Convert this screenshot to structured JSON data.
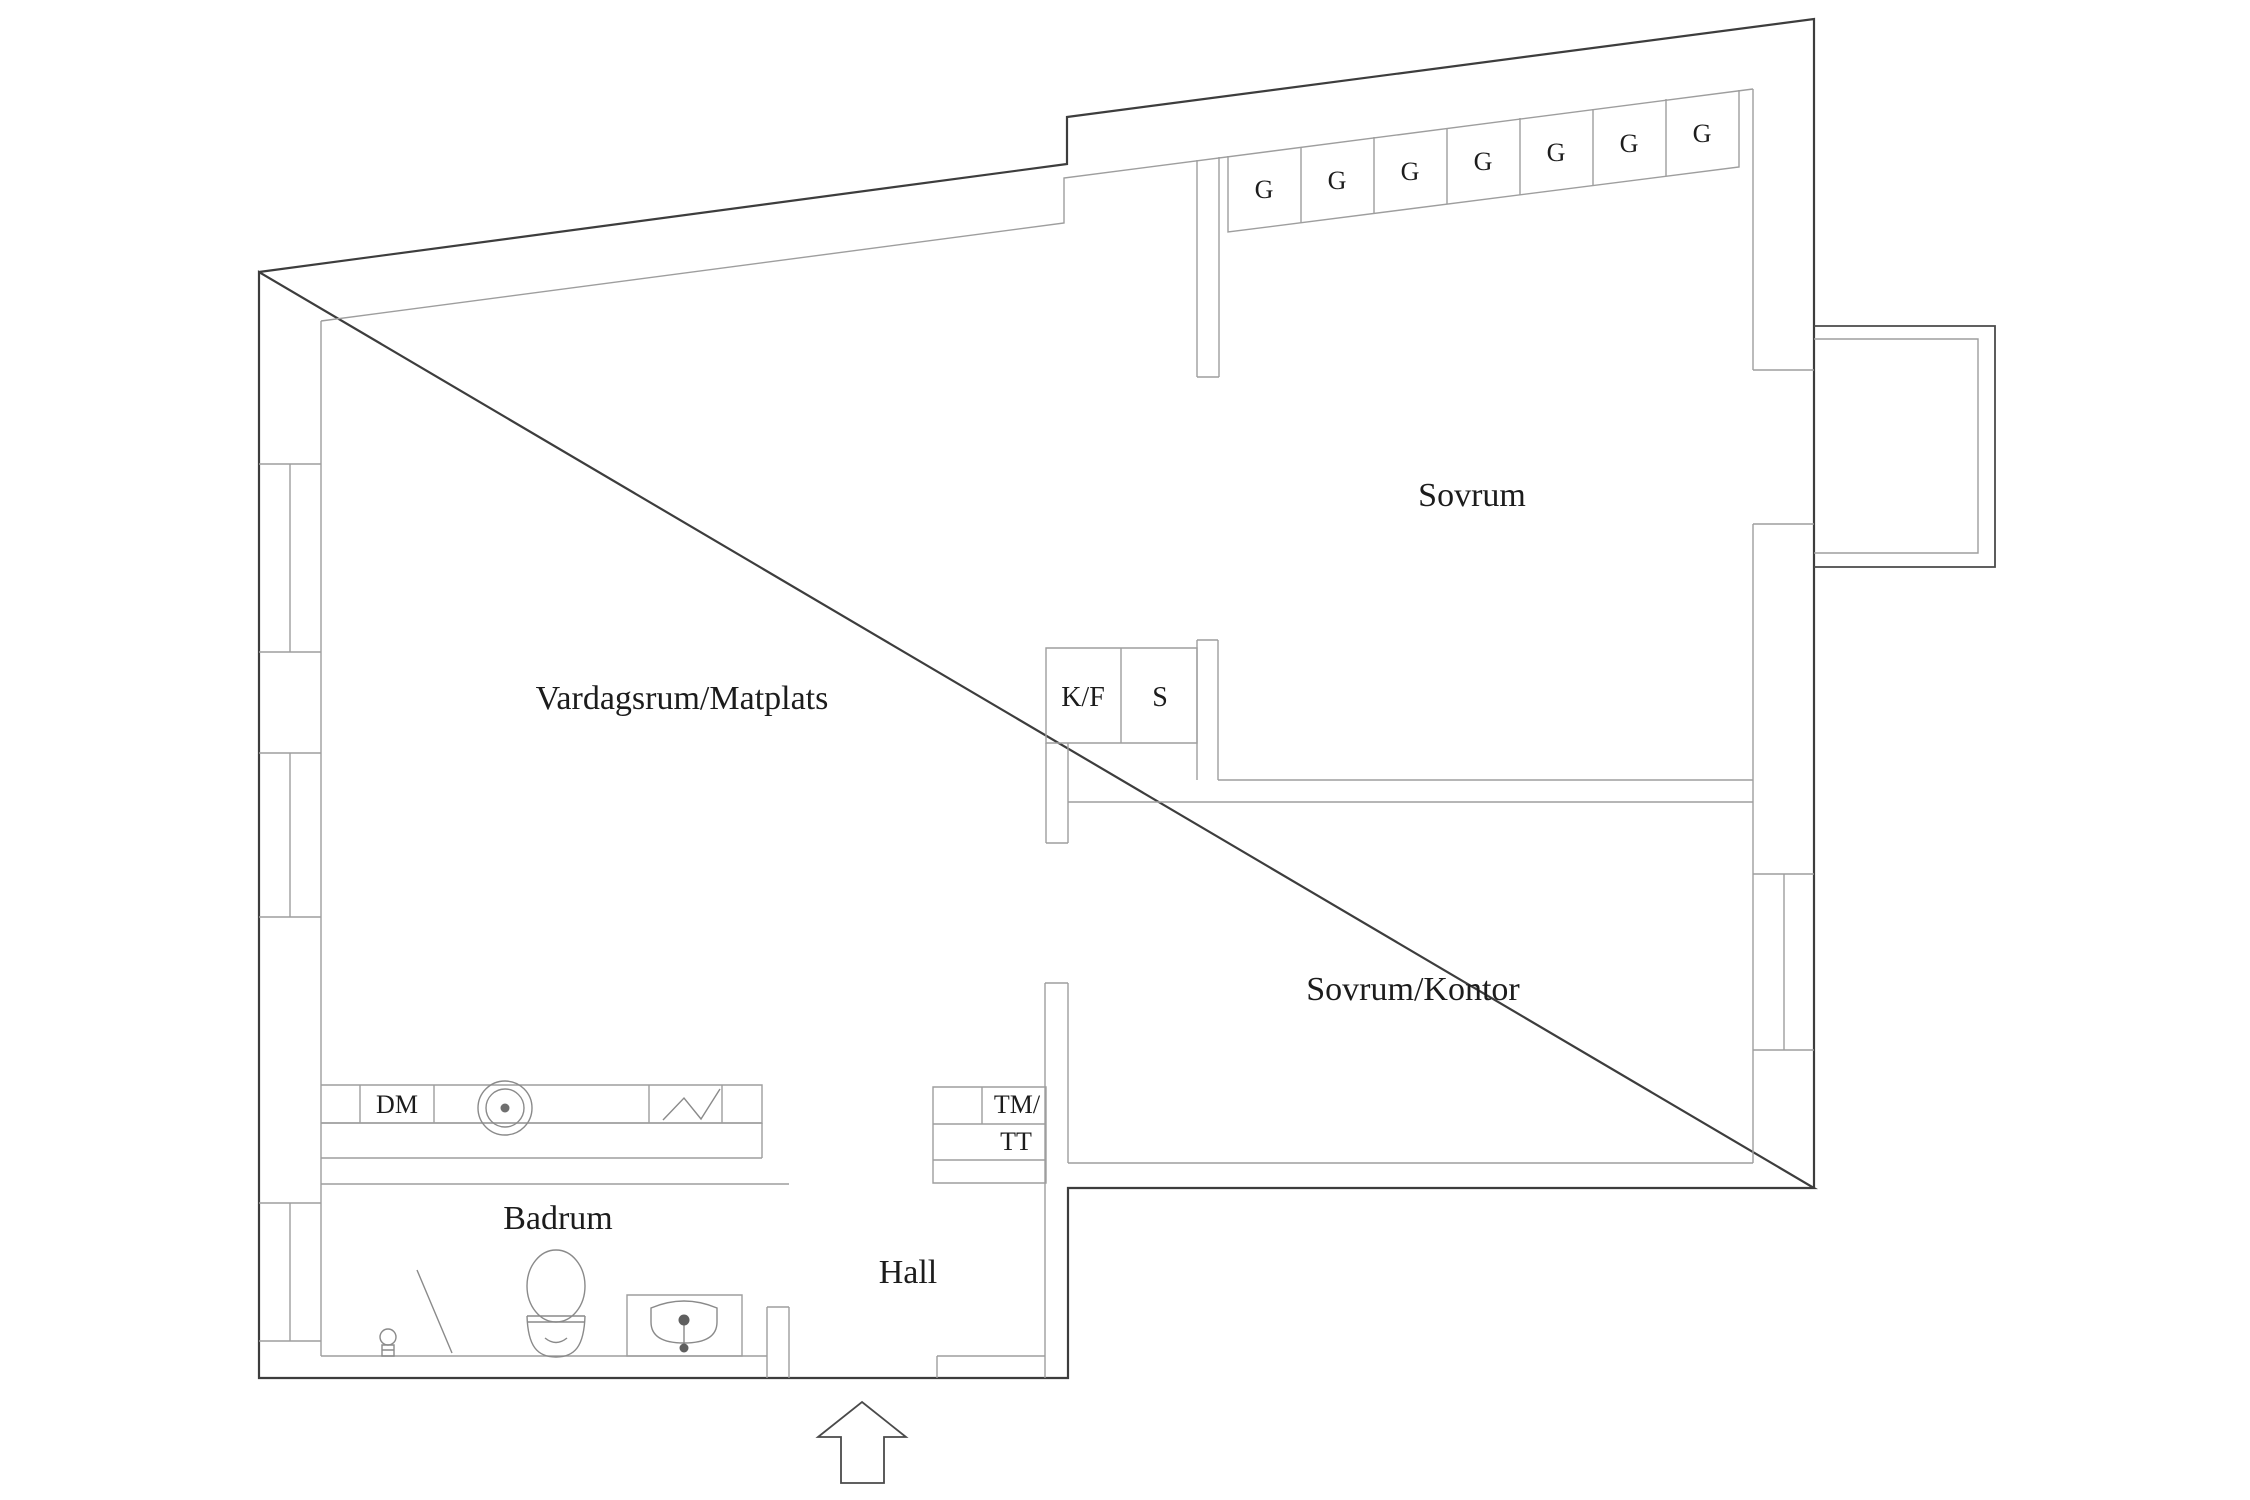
{
  "document": {
    "type": "apartment floor plan",
    "language": "Swedish"
  },
  "rooms": {
    "living": {
      "label": "Vardagsrum/Matplats"
    },
    "bedroom": {
      "label": "Sovrum"
    },
    "bedroom_office": {
      "label": "Sovrum/Kontor"
    },
    "bathroom": {
      "label": "Badrum"
    },
    "hall": {
      "label": "Hall"
    }
  },
  "appliances": {
    "dishwasher": {
      "label": "DM"
    },
    "fridge_freezer": {
      "label": "K/F"
    },
    "pantry": {
      "label": "S"
    },
    "washing_machine": {
      "label": "TM/"
    },
    "tumble_dryer": {
      "label": "TT"
    }
  },
  "wardrobes": {
    "count": 7,
    "labels": [
      "G",
      "G",
      "G",
      "G",
      "G",
      "G",
      "G"
    ]
  },
  "icons": {
    "entrance": "entrance-arrow",
    "toilet": "toilet-icon",
    "washbasin": "washbasin-icon",
    "round_sink": "round-sink-icon",
    "stove": "stove-zigzag-icon",
    "toilet_brush": "toilet-brush-icon",
    "squeegee": "squeegee-icon"
  },
  "colors": {
    "wall_dark": "#3d3d3d",
    "wall_light": "#9e9e9e",
    "text": "#1c1c1c",
    "background": "#ffffff"
  }
}
